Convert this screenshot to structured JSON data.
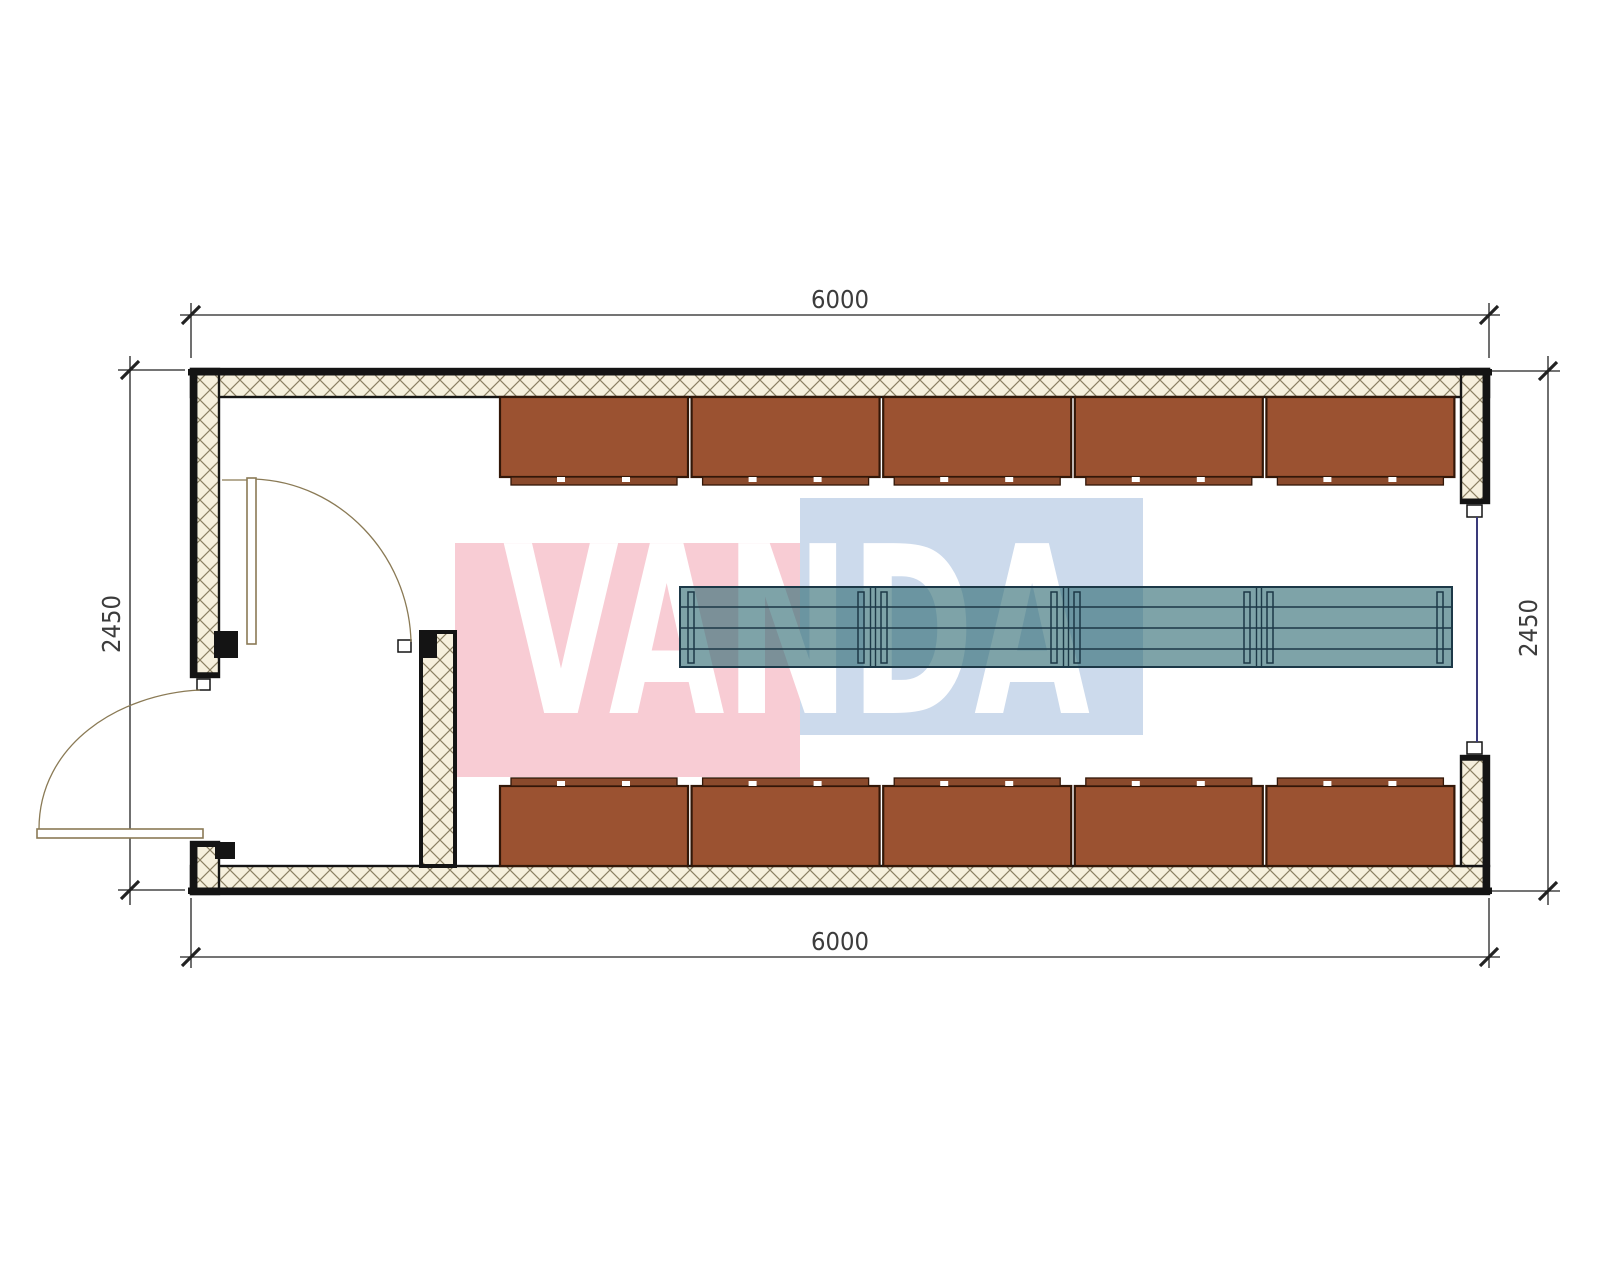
{
  "drawing_type": "container-house floor plan",
  "watermark": {
    "text": "VANDA"
  },
  "dimensions": {
    "top": "6000",
    "bottom": "6000",
    "left": "2450",
    "right": "2450"
  },
  "colors": {
    "wm_pink": "#f8ccd4",
    "wm_blue": "#ccdaec",
    "wm_text": "#ffffff",
    "wall_hatch_bg": "#f6f0dd",
    "wall_hatch_line": "#8b8063",
    "wall_edge": "#141414",
    "cabinet_fill": "#9b5231",
    "cabinet_feet": "#8a4a2c",
    "cabinet_outline": "#321708",
    "table_fill": "#2f6b73",
    "table_outline": "#1c3847",
    "door_line": "#8a7a55",
    "window_line": "#3a3a7a",
    "dim_line": "#222222",
    "dim_text": "#3c3c3c"
  },
  "furniture": {
    "cabinets_top": 5,
    "cabinets_bottom": 5,
    "table_modules": 4
  }
}
